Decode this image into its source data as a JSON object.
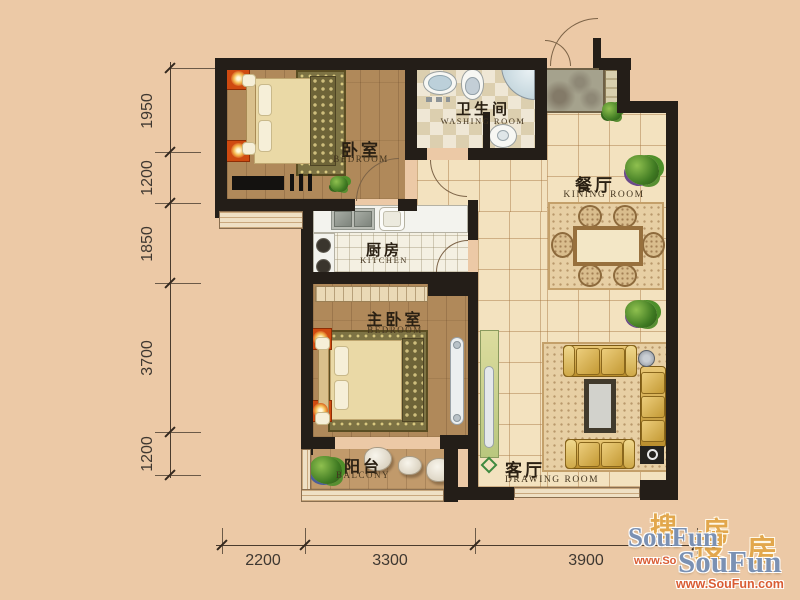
{
  "plan_type": "apartment-floor-plan",
  "rooms": {
    "bedroom1": {
      "zh": "卧室",
      "en": "BEDROOM"
    },
    "bathroom": {
      "zh": "卫生间",
      "en": "WASHING ROOM"
    },
    "dining": {
      "zh": "餐厅",
      "en": "KINING ROOM"
    },
    "kitchen": {
      "zh": "厨房",
      "en": "KITCHEN"
    },
    "master": {
      "zh": "主卧室",
      "en": "BEDROOM"
    },
    "balcony": {
      "zh": "阳台",
      "en": "BALCONY"
    },
    "living": {
      "zh": "客厅",
      "en": "DRAWING ROOM"
    }
  },
  "dimensions": {
    "left": [
      "1950",
      "1200",
      "1850",
      "3700",
      "1200"
    ],
    "bottom": [
      "2200",
      "3300",
      "3900"
    ]
  },
  "watermark": {
    "brand": "SouFun",
    "brand_zh_1": "搜",
    "brand_zh_2": "房",
    "url": "www.SouFun.com",
    "url_partial": "www.So",
    "colors": {
      "brand_blue": "#7b91b3",
      "zh_gold": "#e2a74c",
      "url_red": "#d95c33"
    }
  },
  "palette": {
    "background": "#ecc9a6",
    "wall": "#241e18",
    "tile_floor": "#f3e2bf",
    "wood_floor": "#b0895a",
    "accent_orange": "#cf4a10",
    "plant_green": "#3f7a22",
    "sofa_gold": "#c79a3e"
  }
}
